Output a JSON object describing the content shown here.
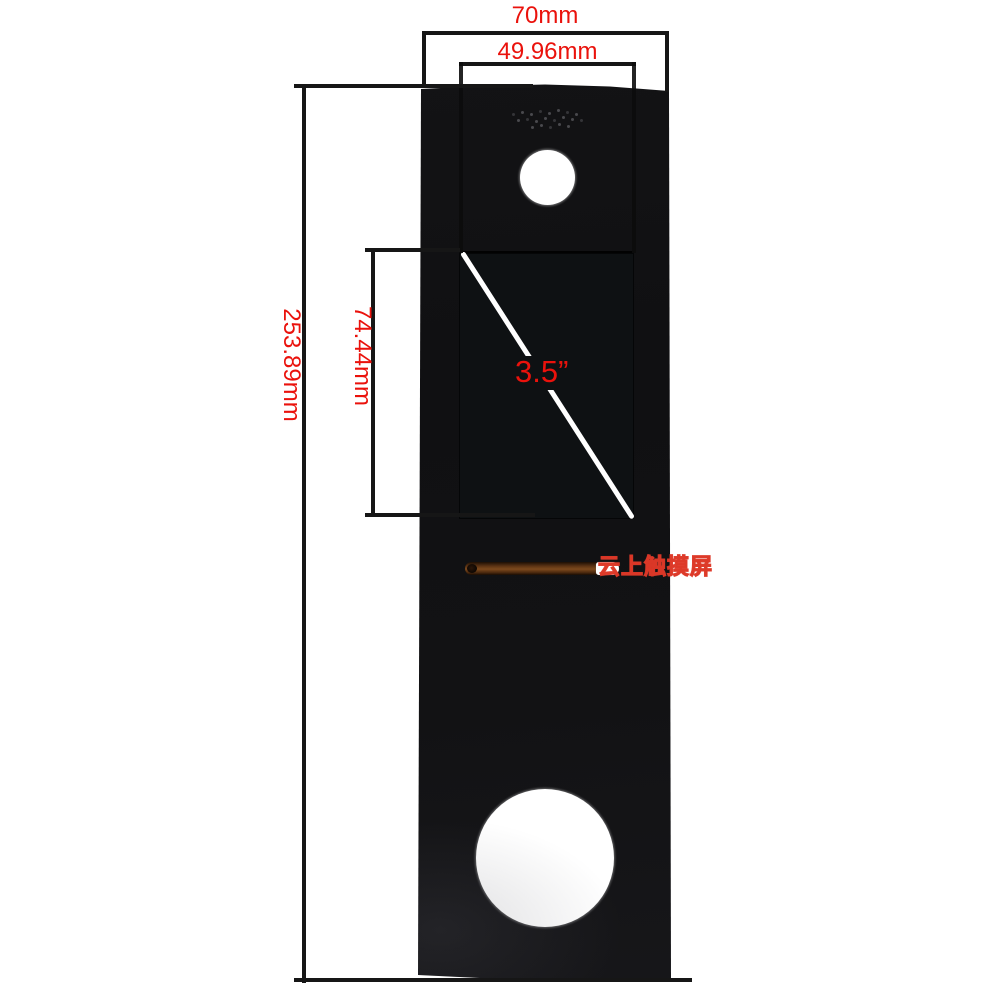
{
  "colors": {
    "background": "#ffffff",
    "panel_black": "#121214",
    "display_black": "#0e1113",
    "dimension_line": "#161616",
    "dimension_text_red": "#ea120c",
    "diagonal_line_white": "#ffffff",
    "slot_copper": "#7d4a1d",
    "watermark_red": "#de3726"
  },
  "dimensions": {
    "outer_width": {
      "label": "70mm"
    },
    "display_width": {
      "label": "49.96mm"
    },
    "outer_height": {
      "label": "253.89mm"
    },
    "display_height": {
      "label": "74.44mm"
    },
    "display_diagonal": {
      "label": "3.5”"
    }
  },
  "watermark": {
    "text": "云上触摸屏"
  }
}
